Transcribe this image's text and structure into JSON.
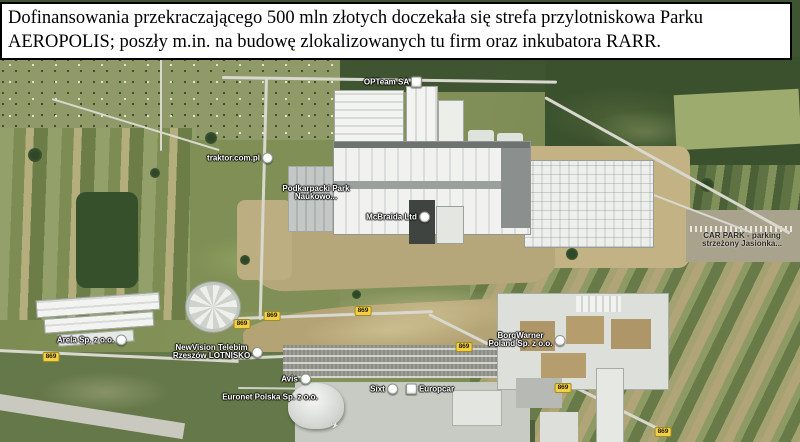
{
  "caption": {
    "line1": "Dofinansowania przekraczającego 500 mln złotych doczekała się strefa przylotniskowa Parku",
    "line2": "AEROPOLIS; poszły m.in. na budowę zlokalizowanych tu firm oraz inkubatora RARR."
  },
  "map": {
    "kind": "satellite-aerial-view",
    "labels": [
      {
        "id": "opteam",
        "line1": "OPTeam SA",
        "icon": "square-poi"
      },
      {
        "id": "traktor",
        "line1": "traktor.com.pl",
        "icon": "circle-poi"
      },
      {
        "id": "podkarpacki-park",
        "line1": "Podkarpacki Park",
        "line2": "Naukowo...",
        "icon": ""
      },
      {
        "id": "mcbraida",
        "line1": "McBraida Ltd",
        "icon": "circle-poi"
      },
      {
        "id": "car-park",
        "line1": "CAR PARK - parking",
        "line2": "strzeżony Jasionka...",
        "icon": ""
      },
      {
        "id": "borgwarner",
        "line1": "BorgWarner",
        "line2": "Poland Sp. z o.o.",
        "icon": "circle-poi"
      },
      {
        "id": "arela",
        "line1": "Arela Sp. z o.o.",
        "icon": "circle-poi"
      },
      {
        "id": "newvision",
        "line1": "NewVision Telebim",
        "line2": "Rzeszów LOTNISKO",
        "icon": "circle-poi"
      },
      {
        "id": "avis",
        "line1": "Avis",
        "icon": "circle-poi"
      },
      {
        "id": "euronet",
        "line1": "Euronet Polska Sp. z o.o.",
        "icon": ""
      },
      {
        "id": "sixt",
        "line1": "Sixt",
        "icon": "circle-poi"
      },
      {
        "id": "europcar",
        "line1": "Europcar",
        "icon": "square-poi"
      }
    ],
    "road_shields": [
      {
        "label": "869"
      },
      {
        "label": "869"
      },
      {
        "label": "869"
      },
      {
        "label": "869"
      },
      {
        "label": "869"
      },
      {
        "label": "869"
      },
      {
        "label": "869"
      }
    ],
    "colors": {
      "shield_bg": "#f2cf43",
      "poi_label_text": "#ffffff",
      "dark_label_text": "#262626",
      "caption_bg": "#ffffff",
      "caption_border": "#000000"
    }
  }
}
